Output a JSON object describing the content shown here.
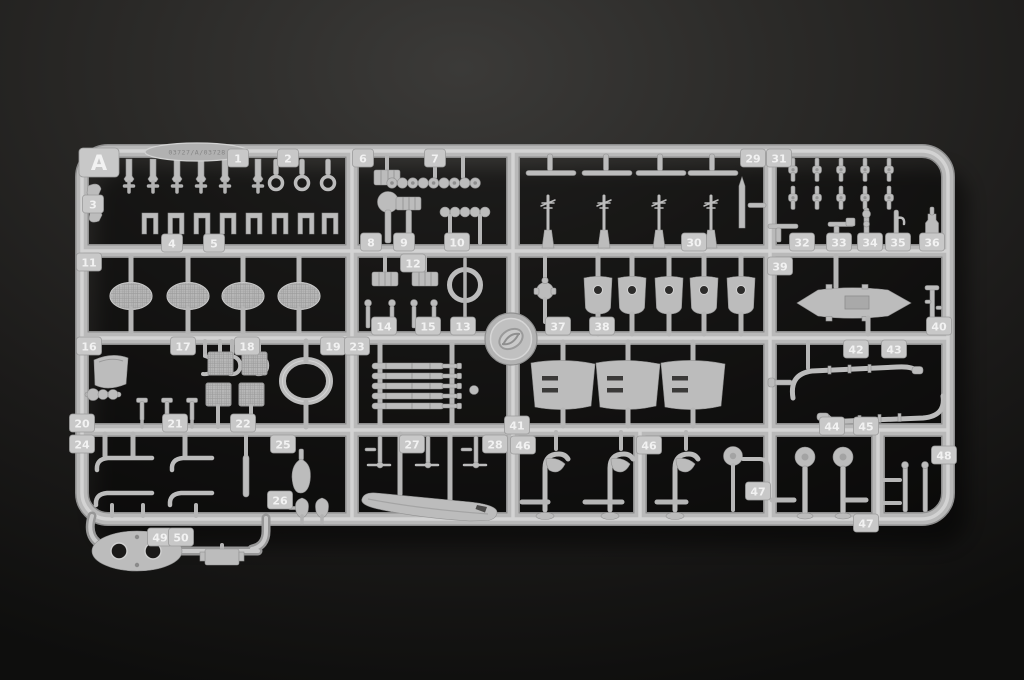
{
  "sprue": {
    "letter": "A",
    "stamp_text": "03727/A/03728",
    "plastic_color": "#bcbcbc",
    "plastic_highlight": "#d7d7d7",
    "plastic_shadow": "#8d8d8d",
    "background_color": "#262523",
    "part_count_range": "1-50",
    "tags": [
      {
        "n": "1",
        "x": 238,
        "y": 158
      },
      {
        "n": "2",
        "x": 288,
        "y": 158
      },
      {
        "n": "3",
        "x": 93,
        "y": 204
      },
      {
        "n": "4",
        "x": 172,
        "y": 243
      },
      {
        "n": "5",
        "x": 214,
        "y": 243
      },
      {
        "n": "6",
        "x": 363,
        "y": 158
      },
      {
        "n": "7",
        "x": 435,
        "y": 158
      },
      {
        "n": "8",
        "x": 371,
        "y": 242
      },
      {
        "n": "9",
        "x": 404,
        "y": 242
      },
      {
        "n": "10",
        "x": 457,
        "y": 242
      },
      {
        "n": "11",
        "x": 89,
        "y": 262
      },
      {
        "n": "12",
        "x": 413,
        "y": 263
      },
      {
        "n": "14",
        "x": 384,
        "y": 326
      },
      {
        "n": "15",
        "x": 428,
        "y": 326
      },
      {
        "n": "13",
        "x": 463,
        "y": 326
      },
      {
        "n": "16",
        "x": 89,
        "y": 346
      },
      {
        "n": "17",
        "x": 183,
        "y": 346
      },
      {
        "n": "18",
        "x": 247,
        "y": 346
      },
      {
        "n": "19",
        "x": 333,
        "y": 346
      },
      {
        "n": "23",
        "x": 357,
        "y": 346
      },
      {
        "n": "20",
        "x": 82,
        "y": 423
      },
      {
        "n": "21",
        "x": 175,
        "y": 423
      },
      {
        "n": "22",
        "x": 243,
        "y": 423
      },
      {
        "n": "24",
        "x": 82,
        "y": 444
      },
      {
        "n": "25",
        "x": 283,
        "y": 444
      },
      {
        "n": "26",
        "x": 280,
        "y": 500
      },
      {
        "n": "27",
        "x": 412,
        "y": 444
      },
      {
        "n": "28",
        "x": 495,
        "y": 444
      },
      {
        "n": "29",
        "x": 753,
        "y": 158
      },
      {
        "n": "30",
        "x": 694,
        "y": 242
      },
      {
        "n": "31",
        "x": 779,
        "y": 158
      },
      {
        "n": "32",
        "x": 802,
        "y": 242
      },
      {
        "n": "33",
        "x": 839,
        "y": 242
      },
      {
        "n": "34",
        "x": 870,
        "y": 242
      },
      {
        "n": "35",
        "x": 898,
        "y": 242
      },
      {
        "n": "36",
        "x": 932,
        "y": 242
      },
      {
        "n": "37",
        "x": 558,
        "y": 326
      },
      {
        "n": "38",
        "x": 602,
        "y": 326
      },
      {
        "n": "39",
        "x": 780,
        "y": 266
      },
      {
        "n": "40",
        "x": 939,
        "y": 326
      },
      {
        "n": "41",
        "x": 517,
        "y": 425
      },
      {
        "n": "42",
        "x": 856,
        "y": 349
      },
      {
        "n": "43",
        "x": 894,
        "y": 349
      },
      {
        "n": "44",
        "x": 832,
        "y": 426
      },
      {
        "n": "45",
        "x": 866,
        "y": 426
      },
      {
        "n": "46",
        "x": 523,
        "y": 445
      },
      {
        "n": "46",
        "x": 649,
        "y": 445
      },
      {
        "n": "47",
        "x": 758,
        "y": 491
      },
      {
        "n": "47",
        "x": 866,
        "y": 523
      },
      {
        "n": "48",
        "x": 944,
        "y": 455
      },
      {
        "n": "49",
        "x": 160,
        "y": 537
      },
      {
        "n": "50",
        "x": 181,
        "y": 537
      }
    ]
  }
}
